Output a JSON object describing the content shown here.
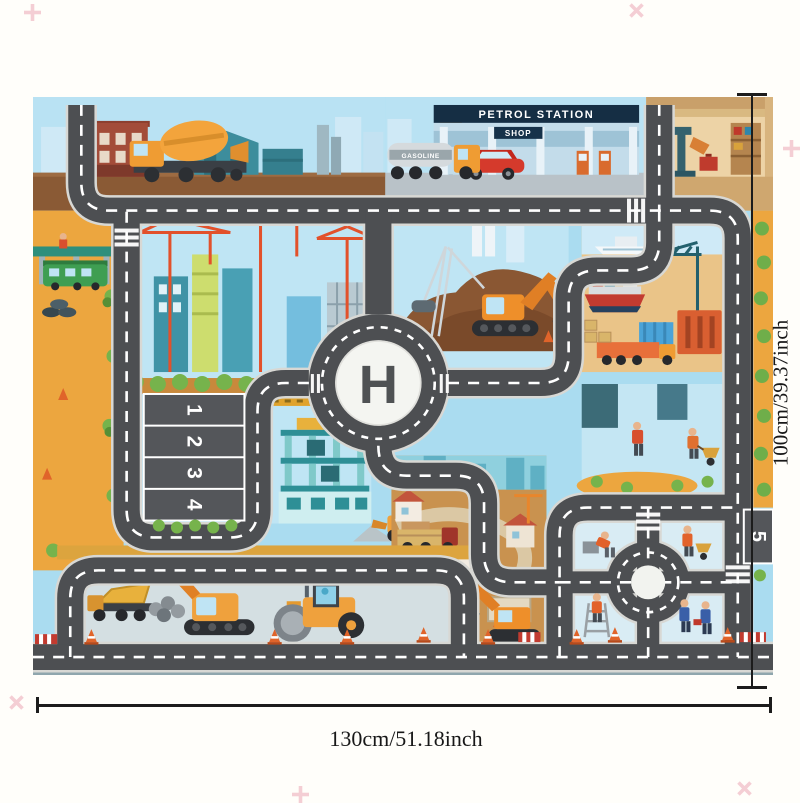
{
  "mat": {
    "labels": {
      "helipad": "H",
      "petrol_station": "PETROL STATION",
      "shop": "SHOP",
      "tanker": "GASOLINE"
    },
    "parking_spots": [
      "1",
      "2",
      "3",
      "4"
    ],
    "parking_spot_5": "5"
  },
  "dimensions": {
    "width": "130cm/51.18inch",
    "height": "100cm/39.37inch"
  },
  "decorations": {
    "sparkle": "plus-star"
  },
  "colors": {
    "road": "#4d4f52",
    "road_edge": "#d8d8d4",
    "road_marking": "#ffffff",
    "sky": "#aadcf0",
    "sand": "#eca63f",
    "dirt": "#8a5a35",
    "machine_orange": "#efa13d",
    "canopy_navy": "#152e44",
    "dimension_line": "#1c1c1c",
    "sparkle_pink": "#f3c6ce"
  }
}
